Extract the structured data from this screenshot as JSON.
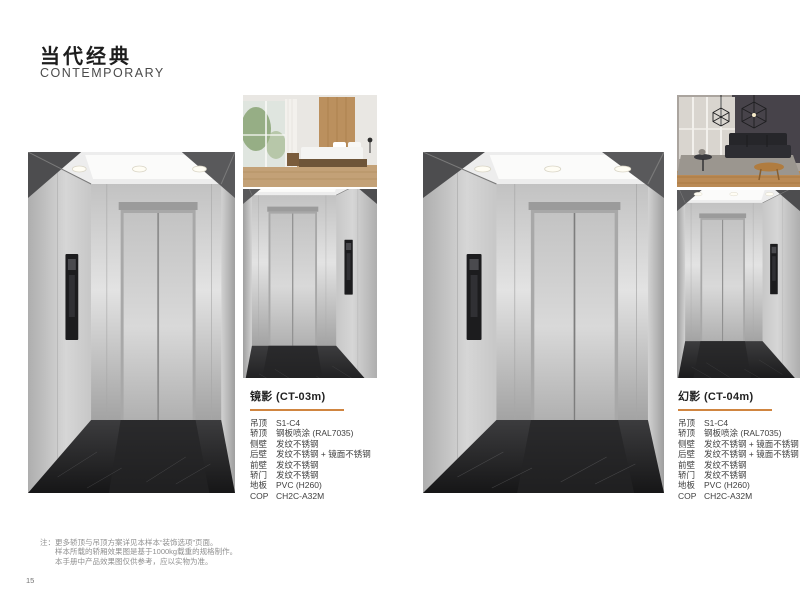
{
  "page": {
    "title_zh": "当代经典",
    "title_en": "CONTEMPORARY",
    "page_number": "15",
    "accent_color": "#D08540"
  },
  "products": [
    {
      "name": "镜影 (CT-03m)",
      "specs": [
        {
          "label": "吊顶",
          "value": "S1-C4"
        },
        {
          "label": "轿顶",
          "value": "钢板喷涂 (RAL7035)"
        },
        {
          "label": "侧壁",
          "value": "发纹不锈钢"
        },
        {
          "label": "后壁",
          "value": "发纹不锈钢 + 镜面不锈钢"
        },
        {
          "label": "前壁",
          "value": "发纹不锈钢"
        },
        {
          "label": "轿门",
          "value": "发纹不锈钢"
        },
        {
          "label": "地板",
          "value": "PVC (H260)"
        },
        {
          "label": "COP",
          "value": "CH2C-A32M"
        }
      ]
    },
    {
      "name": "幻影 (CT-04m)",
      "specs": [
        {
          "label": "吊顶",
          "value": "S1-C4"
        },
        {
          "label": "轿顶",
          "value": "钢板喷涂 (RAL7035)"
        },
        {
          "label": "侧壁",
          "value": "发纹不锈钢 + 镜面不锈钢"
        },
        {
          "label": "后壁",
          "value": "发纹不锈钢 + 镜面不锈钢"
        },
        {
          "label": "前壁",
          "value": "发纹不锈钢"
        },
        {
          "label": "轿门",
          "value": "发纹不锈钢"
        },
        {
          "label": "地板",
          "value": "PVC (H260)"
        },
        {
          "label": "COP",
          "value": "CH2C-A32M"
        }
      ]
    }
  ],
  "footnote": {
    "lines": [
      "注：更多轿顶与吊顶方案详见本样本“装饰选项”页面。",
      "样本所载的轿厢效果图是基于1000kg载重的规格制作。",
      "本手册中产品效果图仅供参考，应以实物为准。"
    ]
  }
}
